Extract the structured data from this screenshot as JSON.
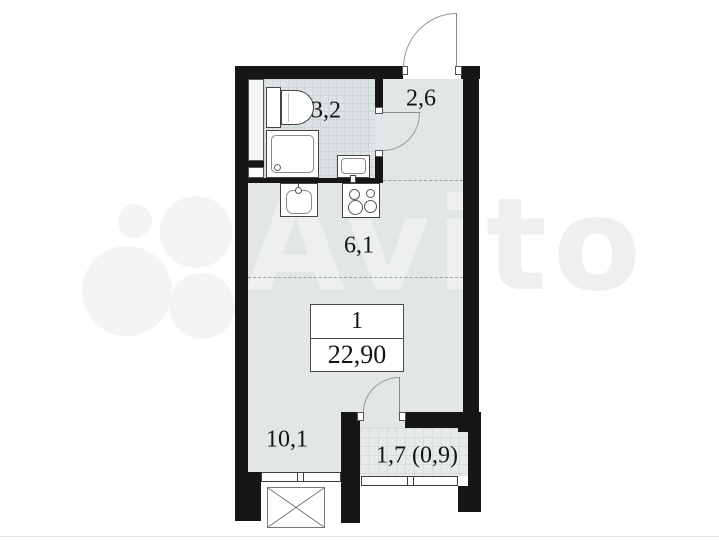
{
  "watermark": {
    "brand": "Avito"
  },
  "plan": {
    "rooms": [
      {
        "name": "bathroom",
        "area_label": "3,2"
      },
      {
        "name": "hallway",
        "area_label": "2,6"
      },
      {
        "name": "kitchen",
        "area_label": "6,1"
      },
      {
        "name": "living-room",
        "area_label": "10,1"
      },
      {
        "name": "balcony",
        "area_label": "1,7 (0,9)"
      }
    ],
    "info_box": {
      "rooms_count": "1",
      "total_area": "22,90"
    },
    "fixtures": [
      "toilet",
      "shower",
      "bathroom-sink",
      "kitchen-sink",
      "stove",
      "bay-window"
    ],
    "colors": {
      "wall": "#161616",
      "floor": "#e2e6e7",
      "bath_tile": "#dde3e4",
      "balcony_tile": "#e7eaea"
    }
  }
}
